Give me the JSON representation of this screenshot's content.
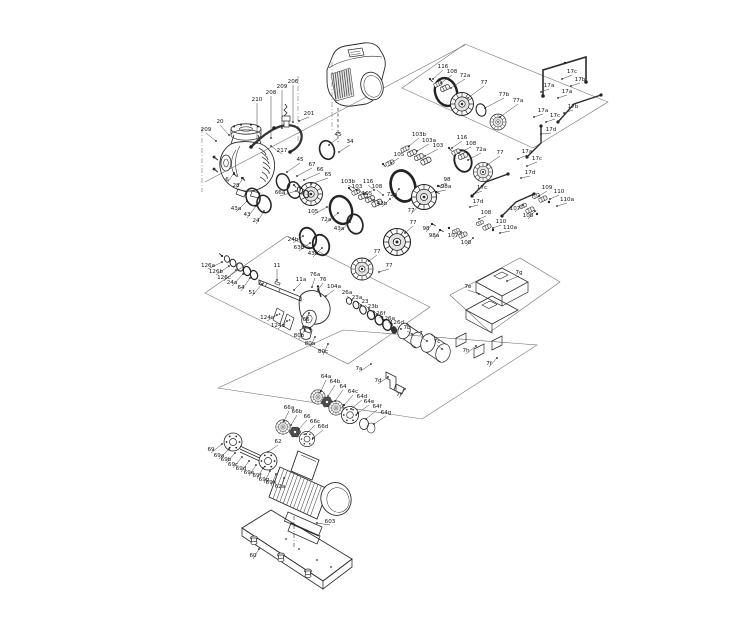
{
  "diagram": {
    "colors": {
      "background": "#ffffff",
      "line": "#2b2b2b",
      "label": "#141414"
    },
    "part_labels": [
      {
        "t": "209",
        "x": 206,
        "y": 131,
        "lx": 216,
        "ly": 141
      },
      {
        "t": "20",
        "x": 220,
        "y": 123,
        "lx": 229,
        "ly": 135
      },
      {
        "t": "210",
        "x": 257,
        "y": 101,
        "lx": 257,
        "ly": 143
      },
      {
        "t": "208",
        "x": 271,
        "y": 94,
        "lx": 271,
        "ly": 138
      },
      {
        "t": "209",
        "x": 282,
        "y": 88,
        "lx": 282,
        "ly": 128
      },
      {
        "t": "206",
        "x": 293,
        "y": 83,
        "lx": 293,
        "ly": 122
      },
      {
        "t": "201",
        "x": 309,
        "y": 115,
        "lx": 299,
        "ly": 121
      },
      {
        "t": "217",
        "x": 282,
        "y": 152,
        "lx": 271,
        "ly": 146
      },
      {
        "t": "6",
        "x": 227,
        "y": 181,
        "lx": 234,
        "ly": 173
      },
      {
        "t": "28",
        "x": 236,
        "y": 187,
        "lx": 243,
        "ly": 178
      },
      {
        "t": "66a",
        "x": 280,
        "y": 194,
        "lx": 296,
        "ly": 191
      },
      {
        "t": "45",
        "x": 338,
        "y": 136,
        "lx": 329,
        "ly": 145
      },
      {
        "t": "34",
        "x": 350,
        "y": 143,
        "lx": 339,
        "ly": 152
      },
      {
        "t": "45",
        "x": 300,
        "y": 161,
        "lx": 287,
        "ly": 172
      },
      {
        "t": "67",
        "x": 312,
        "y": 166,
        "lx": 297,
        "ly": 176
      },
      {
        "t": "66",
        "x": 320,
        "y": 171,
        "lx": 304,
        "ly": 180
      },
      {
        "t": "65",
        "x": 328,
        "y": 176,
        "lx": 311,
        "ly": 184
      },
      {
        "t": "105",
        "x": 313,
        "y": 213,
        "lx": 327,
        "ly": 207
      },
      {
        "t": "72a",
        "x": 326,
        "y": 221,
        "lx": 338,
        "ly": 213
      },
      {
        "t": "43a",
        "x": 236,
        "y": 210,
        "lx": 247,
        "ly": 201
      },
      {
        "t": "43",
        "x": 247,
        "y": 216,
        "lx": 256,
        "ly": 206
      },
      {
        "t": "24",
        "x": 256,
        "y": 222,
        "lx": 264,
        "ly": 211
      },
      {
        "t": "43a",
        "x": 339,
        "y": 230,
        "lx": 350,
        "ly": 222
      },
      {
        "t": "24b",
        "x": 293,
        "y": 241,
        "lx": 303,
        "ly": 236
      },
      {
        "t": "63b",
        "x": 299,
        "y": 249,
        "lx": 310,
        "ly": 243
      },
      {
        "t": "43b",
        "x": 313,
        "y": 255,
        "lx": 322,
        "ly": 248
      },
      {
        "t": "116",
        "x": 443,
        "y": 68,
        "lx": 433,
        "ly": 79
      },
      {
        "t": "108",
        "x": 452,
        "y": 73,
        "lx": 441,
        "ly": 83
      },
      {
        "t": "72a",
        "x": 465,
        "y": 77,
        "lx": 451,
        "ly": 88
      },
      {
        "t": "77",
        "x": 484,
        "y": 84,
        "lx": 468,
        "ly": 98
      },
      {
        "t": "77b",
        "x": 504,
        "y": 96,
        "lx": 485,
        "ly": 108
      },
      {
        "t": "77a",
        "x": 518,
        "y": 102,
        "lx": 500,
        "ly": 117
      },
      {
        "t": "17c",
        "x": 572,
        "y": 73,
        "lx": 562,
        "ly": 79
      },
      {
        "t": "17b",
        "x": 580,
        "y": 81,
        "lx": 571,
        "ly": 86
      },
      {
        "t": "17a",
        "x": 549,
        "y": 87,
        "lx": 541,
        "ly": 92
      },
      {
        "t": "17a",
        "x": 567,
        "y": 93,
        "lx": 558,
        "ly": 98
      },
      {
        "t": "17b",
        "x": 573,
        "y": 108,
        "lx": 564,
        "ly": 113
      },
      {
        "t": "17a",
        "x": 543,
        "y": 112,
        "lx": 534,
        "ly": 117
      },
      {
        "t": "17c",
        "x": 555,
        "y": 117,
        "lx": 546,
        "ly": 122
      },
      {
        "t": "17d",
        "x": 551,
        "y": 131,
        "lx": 541,
        "ly": 134
      },
      {
        "t": "103b",
        "x": 419,
        "y": 136,
        "lx": 409,
        "ly": 146
      },
      {
        "t": "103a",
        "x": 429,
        "y": 142,
        "lx": 417,
        "ly": 151
      },
      {
        "t": "103",
        "x": 438,
        "y": 147,
        "lx": 425,
        "ly": 156
      },
      {
        "t": "105",
        "x": 399,
        "y": 156,
        "lx": 391,
        "ly": 163
      },
      {
        "t": "116",
        "x": 462,
        "y": 139,
        "lx": 452,
        "ly": 148
      },
      {
        "t": "108",
        "x": 471,
        "y": 145,
        "lx": 459,
        "ly": 153
      },
      {
        "t": "72a",
        "x": 481,
        "y": 151,
        "lx": 468,
        "ly": 160
      },
      {
        "t": "77",
        "x": 500,
        "y": 154,
        "lx": 487,
        "ly": 165
      },
      {
        "t": "17a",
        "x": 527,
        "y": 153,
        "lx": 518,
        "ly": 159
      },
      {
        "t": "17c",
        "x": 537,
        "y": 160,
        "lx": 527,
        "ly": 166
      },
      {
        "t": "17d",
        "x": 530,
        "y": 174,
        "lx": 521,
        "ly": 178
      },
      {
        "t": "98",
        "x": 447,
        "y": 181,
        "lx": 438,
        "ly": 186
      },
      {
        "t": "98a",
        "x": 446,
        "y": 188,
        "lx": 436,
        "ly": 192
      },
      {
        "t": "103b",
        "x": 348,
        "y": 183,
        "lx": 357,
        "ly": 190
      },
      {
        "t": "103",
        "x": 357,
        "y": 188,
        "lx": 365,
        "ly": 194
      },
      {
        "t": "116",
        "x": 368,
        "y": 183,
        "lx": 374,
        "ly": 190
      },
      {
        "t": "108",
        "x": 377,
        "y": 188,
        "lx": 383,
        "ly": 195
      },
      {
        "t": "105",
        "x": 367,
        "y": 195,
        "lx": 374,
        "ly": 200
      },
      {
        "t": "72a",
        "x": 392,
        "y": 196,
        "lx": 399,
        "ly": 189
      },
      {
        "t": "43b",
        "x": 382,
        "y": 205,
        "lx": 390,
        "ly": 199
      },
      {
        "t": "77",
        "x": 411,
        "y": 212,
        "lx": 420,
        "ly": 204
      },
      {
        "t": "98",
        "x": 426,
        "y": 230,
        "lx": 432,
        "ly": 224
      },
      {
        "t": "98a",
        "x": 434,
        "y": 237,
        "lx": 440,
        "ly": 230
      },
      {
        "t": "77",
        "x": 413,
        "y": 224,
        "lx": 405,
        "ly": 233
      },
      {
        "t": "77",
        "x": 377,
        "y": 253,
        "lx": 369,
        "ly": 261
      },
      {
        "t": "77",
        "x": 389,
        "y": 267,
        "lx": 379,
        "ly": 272
      },
      {
        "t": "107",
        "x": 453,
        "y": 237,
        "lx": 461,
        "ly": 232
      },
      {
        "t": "108",
        "x": 466,
        "y": 244,
        "lx": 473,
        "ly": 238
      },
      {
        "t": "110",
        "x": 501,
        "y": 223,
        "lx": 493,
        "ly": 228
      },
      {
        "t": "110a",
        "x": 510,
        "y": 229,
        "lx": 500,
        "ly": 233
      },
      {
        "t": "108",
        "x": 486,
        "y": 214,
        "lx": 479,
        "ly": 219
      },
      {
        "t": "109",
        "x": 547,
        "y": 189,
        "lx": 539,
        "ly": 196
      },
      {
        "t": "110",
        "x": 559,
        "y": 193,
        "lx": 550,
        "ly": 199
      },
      {
        "t": "110a",
        "x": 567,
        "y": 201,
        "lx": 557,
        "ly": 206
      },
      {
        "t": "107",
        "x": 515,
        "y": 210,
        "lx": 523,
        "ly": 205
      },
      {
        "t": "108",
        "x": 528,
        "y": 217,
        "lx": 535,
        "ly": 211
      },
      {
        "t": "17c",
        "x": 482,
        "y": 189,
        "lx": 474,
        "ly": 194
      },
      {
        "t": "17d",
        "x": 478,
        "y": 203,
        "lx": 470,
        "ly": 207
      },
      {
        "t": "126a",
        "x": 208,
        "y": 267,
        "lx": 222,
        "ly": 262
      },
      {
        "t": "126b",
        "x": 216,
        "y": 273,
        "lx": 229,
        "ly": 266
      },
      {
        "t": "126c",
        "x": 224,
        "y": 279,
        "lx": 236,
        "ly": 270
      },
      {
        "t": "24a",
        "x": 232,
        "y": 284,
        "lx": 243,
        "ly": 274
      },
      {
        "t": "64",
        "x": 241,
        "y": 289,
        "lx": 250,
        "ly": 278
      },
      {
        "t": "51",
        "x": 252,
        "y": 294,
        "lx": 262,
        "ly": 284
      },
      {
        "t": "11",
        "x": 277,
        "y": 267,
        "lx": 277,
        "ly": 280
      },
      {
        "t": "11a",
        "x": 301,
        "y": 281,
        "lx": 294,
        "ly": 290
      },
      {
        "t": "76a",
        "x": 315,
        "y": 276,
        "lx": 312,
        "ly": 287
      },
      {
        "t": "76",
        "x": 323,
        "y": 281,
        "lx": 318,
        "ly": 290
      },
      {
        "t": "104a",
        "x": 334,
        "y": 288,
        "lx": 326,
        "ly": 296
      },
      {
        "t": "26a",
        "x": 347,
        "y": 294,
        "lx": 352,
        "ly": 300
      },
      {
        "t": "23a",
        "x": 357,
        "y": 299,
        "lx": 361,
        "ly": 305
      },
      {
        "t": "23",
        "x": 365,
        "y": 303,
        "lx": 369,
        "ly": 309
      },
      {
        "t": "23b",
        "x": 373,
        "y": 308,
        "lx": 377,
        "ly": 314
      },
      {
        "t": "126f",
        "x": 379,
        "y": 315,
        "lx": 384,
        "ly": 320
      },
      {
        "t": "126a",
        "x": 388,
        "y": 320,
        "lx": 392,
        "ly": 325
      },
      {
        "t": "126d",
        "x": 397,
        "y": 324,
        "lx": 401,
        "ly": 329
      },
      {
        "t": "7b",
        "x": 407,
        "y": 329,
        "lx": 412,
        "ly": 334
      },
      {
        "t": "7",
        "x": 421,
        "y": 335,
        "lx": 427,
        "ly": 341
      },
      {
        "t": "7c",
        "x": 437,
        "y": 343,
        "lx": 442,
        "ly": 349
      },
      {
        "t": "124c",
        "x": 267,
        "y": 319,
        "lx": 277,
        "ly": 315
      },
      {
        "t": "124d",
        "x": 278,
        "y": 327,
        "lx": 287,
        "ly": 321
      },
      {
        "t": "66",
        "x": 306,
        "y": 321,
        "lx": 309,
        "ly": 313
      },
      {
        "t": "80b",
        "x": 299,
        "y": 337,
        "lx": 305,
        "ly": 330
      },
      {
        "t": "80a",
        "x": 310,
        "y": 345,
        "lx": 315,
        "ly": 337
      },
      {
        "t": "80c",
        "x": 323,
        "y": 353,
        "lx": 328,
        "ly": 344
      },
      {
        "t": "7a",
        "x": 359,
        "y": 370,
        "lx": 371,
        "ly": 364
      },
      {
        "t": "7d",
        "x": 378,
        "y": 382,
        "lx": 388,
        "ly": 377
      },
      {
        "t": "7f",
        "x": 399,
        "y": 396,
        "lx": 405,
        "ly": 389
      },
      {
        "t": "7g",
        "x": 519,
        "y": 274,
        "lx": 507,
        "ly": 281
      },
      {
        "t": "7e",
        "x": 468,
        "y": 288,
        "lx": 479,
        "ly": 294
      },
      {
        "t": "7h",
        "x": 466,
        "y": 352,
        "lx": 476,
        "ly": 346
      },
      {
        "t": "7f",
        "x": 489,
        "y": 365,
        "lx": 497,
        "ly": 358
      },
      {
        "t": "64a",
        "x": 326,
        "y": 378,
        "lx": 321,
        "ly": 391
      },
      {
        "t": "64b",
        "x": 335,
        "y": 383,
        "lx": 328,
        "ly": 396
      },
      {
        "t": "64",
        "x": 343,
        "y": 388,
        "lx": 335,
        "ly": 401
      },
      {
        "t": "64c",
        "x": 353,
        "y": 393,
        "lx": 344,
        "ly": 405
      },
      {
        "t": "64d",
        "x": 362,
        "y": 398,
        "lx": 351,
        "ly": 409
      },
      {
        "t": "64e",
        "x": 369,
        "y": 403,
        "lx": 358,
        "ly": 413
      },
      {
        "t": "64f",
        "x": 377,
        "y": 408,
        "lx": 366,
        "ly": 419
      },
      {
        "t": "64g",
        "x": 386,
        "y": 414,
        "lx": 374,
        "ly": 424
      },
      {
        "t": "66a",
        "x": 289,
        "y": 409,
        "lx": 284,
        "ly": 421
      },
      {
        "t": "66b",
        "x": 297,
        "y": 413,
        "lx": 291,
        "ly": 425
      },
      {
        "t": "66",
        "x": 307,
        "y": 418,
        "lx": 299,
        "ly": 429
      },
      {
        "t": "66c",
        "x": 315,
        "y": 423,
        "lx": 306,
        "ly": 434
      },
      {
        "t": "66d",
        "x": 323,
        "y": 428,
        "lx": 313,
        "ly": 438
      },
      {
        "t": "62",
        "x": 278,
        "y": 443,
        "lx": 268,
        "ly": 452
      },
      {
        "t": "69",
        "x": 211,
        "y": 451,
        "lx": 222,
        "ly": 444
      },
      {
        "t": "69a",
        "x": 219,
        "y": 457,
        "lx": 229,
        "ly": 449
      },
      {
        "t": "69b",
        "x": 226,
        "y": 461,
        "lx": 235,
        "ly": 453
      },
      {
        "t": "69c",
        "x": 233,
        "y": 466,
        "lx": 242,
        "ly": 457
      },
      {
        "t": "69d",
        "x": 241,
        "y": 470,
        "lx": 249,
        "ly": 461
      },
      {
        "t": "69e",
        "x": 249,
        "y": 474,
        "lx": 256,
        "ly": 465
      },
      {
        "t": "69f",
        "x": 257,
        "y": 477,
        "lx": 263,
        "ly": 468
      },
      {
        "t": "69g",
        "x": 264,
        "y": 481,
        "lx": 270,
        "ly": 471
      },
      {
        "t": "69h",
        "x": 271,
        "y": 484,
        "lx": 276,
        "ly": 474
      },
      {
        "t": "62a",
        "x": 280,
        "y": 488,
        "lx": 284,
        "ly": 478
      },
      {
        "t": "603",
        "x": 330,
        "y": 523,
        "lx": 317,
        "ly": 523
      },
      {
        "t": "60",
        "x": 253,
        "y": 557,
        "lx": 259,
        "ly": 549
      }
    ]
  }
}
